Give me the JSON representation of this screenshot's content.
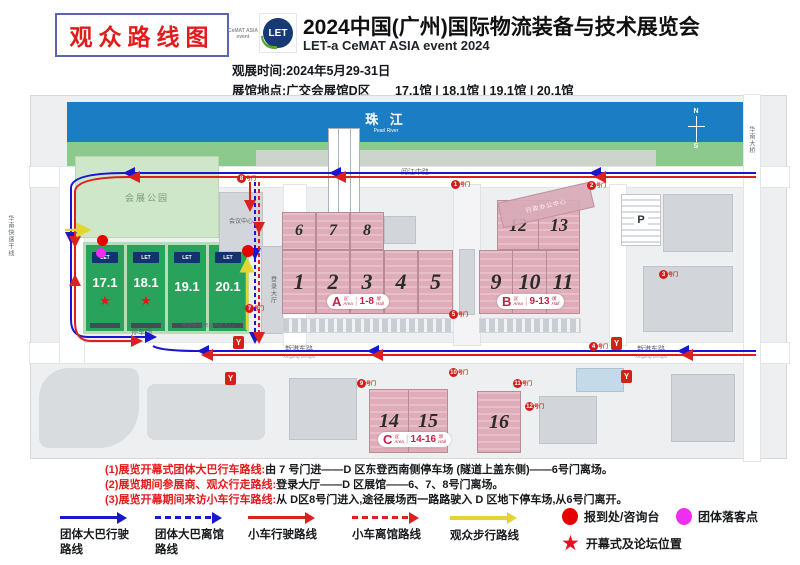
{
  "header": {
    "badge": "观众路线图",
    "logo": {
      "cemat": "CeMAT ASIA",
      "cemat_sub": "event",
      "let": "LET"
    },
    "title": "2024中国(广州)国际物流装备与技术展览会",
    "subtitle": "LET-a CeMAT ASIA event 2024",
    "time_line": "观展时间:2024年5月29-31日",
    "venue_line": "展馆地点:广交会展馆D区",
    "halls_line": "17.1馆 | 18.1馆 | 19.1馆 | 20.1馆"
  },
  "map": {
    "river_cn": "珠 江",
    "river_en": "Pearl River",
    "compass_n": "N",
    "compass_s": "S",
    "park": "会展公园",
    "conference": "会议中心",
    "registration": "登录大厅",
    "admin": "行政办公中心",
    "parking_p": "P",
    "parking_lot": "停车场",
    "station": "地铁新港东站A出入口",
    "metro_logo": "Y",
    "star_glyph": "★",
    "roads": {
      "north": "阅江中路",
      "south": "新港东路",
      "south_en": "Xingang Donglu",
      "west": "华南快速干线",
      "east": "华南大桥"
    },
    "d_halls": [
      {
        "num": "17.1"
      },
      {
        "num": "18.1"
      },
      {
        "num": "19.1"
      },
      {
        "num": "20.1"
      }
    ],
    "a_top": [
      "6",
      "7",
      "8"
    ],
    "a_bottom": [
      "1",
      "2",
      "3",
      "4",
      "5"
    ],
    "b_top": [
      "12",
      "13"
    ],
    "b_bottom": [
      "9",
      "10",
      "11"
    ],
    "c_halls": [
      "14",
      "15",
      "16"
    ],
    "badges": {
      "a": {
        "letter": "A",
        "zone_cn": "区",
        "zone_en": "Area",
        "range": "1-8",
        "hall_cn": "馆",
        "hall_en": "Hall"
      },
      "b": {
        "letter": "B",
        "zone_cn": "区",
        "zone_en": "Area",
        "range": "9-13",
        "hall_cn": "馆",
        "hall_en": "Hall"
      },
      "c": {
        "letter": "C",
        "zone_cn": "区",
        "zone_en": "Area",
        "range": "14-16",
        "hall_cn": "馆",
        "hall_en": "Hall"
      }
    },
    "gate_suffix": "号门",
    "gates": [
      {
        "n": "8"
      },
      {
        "n": "1"
      },
      {
        "n": "2"
      },
      {
        "n": "3"
      },
      {
        "n": "5"
      },
      {
        "n": "4"
      },
      {
        "n": "7"
      },
      {
        "n": "9"
      },
      {
        "n": "10"
      },
      {
        "n": "11"
      },
      {
        "n": "12"
      }
    ]
  },
  "notes": [
    {
      "label": "(1)展览开幕式团体大巴行车路线:",
      "text": "由 7 号门进——D 区东登西南侧停车场 (隧道上盖东侧)——6号门离场。"
    },
    {
      "label": "(2)展览期间参展商、观众行走路线:",
      "text": "登录大厅——D 区展馆——6、7、8号门离场。"
    },
    {
      "label": "(3)展览开幕期间来访小车行车路线:",
      "text": "从 D区8号门进入,途径展场西一路路驶入 D 区地下停车场,从6号门离开。"
    }
  ],
  "legend": {
    "routes": [
      {
        "style": "solid",
        "color": "#1717cf",
        "label": "团体大巴行驶\n路线"
      },
      {
        "style": "dashed",
        "color": "#1717cf",
        "label": "团体大巴离馆\n路线"
      },
      {
        "style": "solid",
        "color": "#dc1f1f",
        "label": "小车行驶路线"
      },
      {
        "style": "dashed",
        "color": "#dc1f1f",
        "label": "小车离馆路线"
      },
      {
        "style": "solid",
        "color": "#e3d52e",
        "label": "观众步行路线"
      }
    ],
    "markers": [
      {
        "shape": "circle",
        "color": "#e60000",
        "label": "报到处/咨询台"
      },
      {
        "shape": "circle",
        "color": "#f02df0",
        "label": "团体落客点"
      },
      {
        "shape": "star",
        "color": "#e8101c",
        "label": "开幕式及论坛位置"
      }
    ]
  },
  "colors": {
    "route_blue": "#1717cf",
    "route_red": "#dc1f1f",
    "route_yellow": "#e3d52e",
    "marker_red": "#e60000",
    "marker_magenta": "#f02df0",
    "hall_green": "#29a35c",
    "hall_pink": "#dfadb9",
    "river_blue": "#1b7ec4"
  }
}
